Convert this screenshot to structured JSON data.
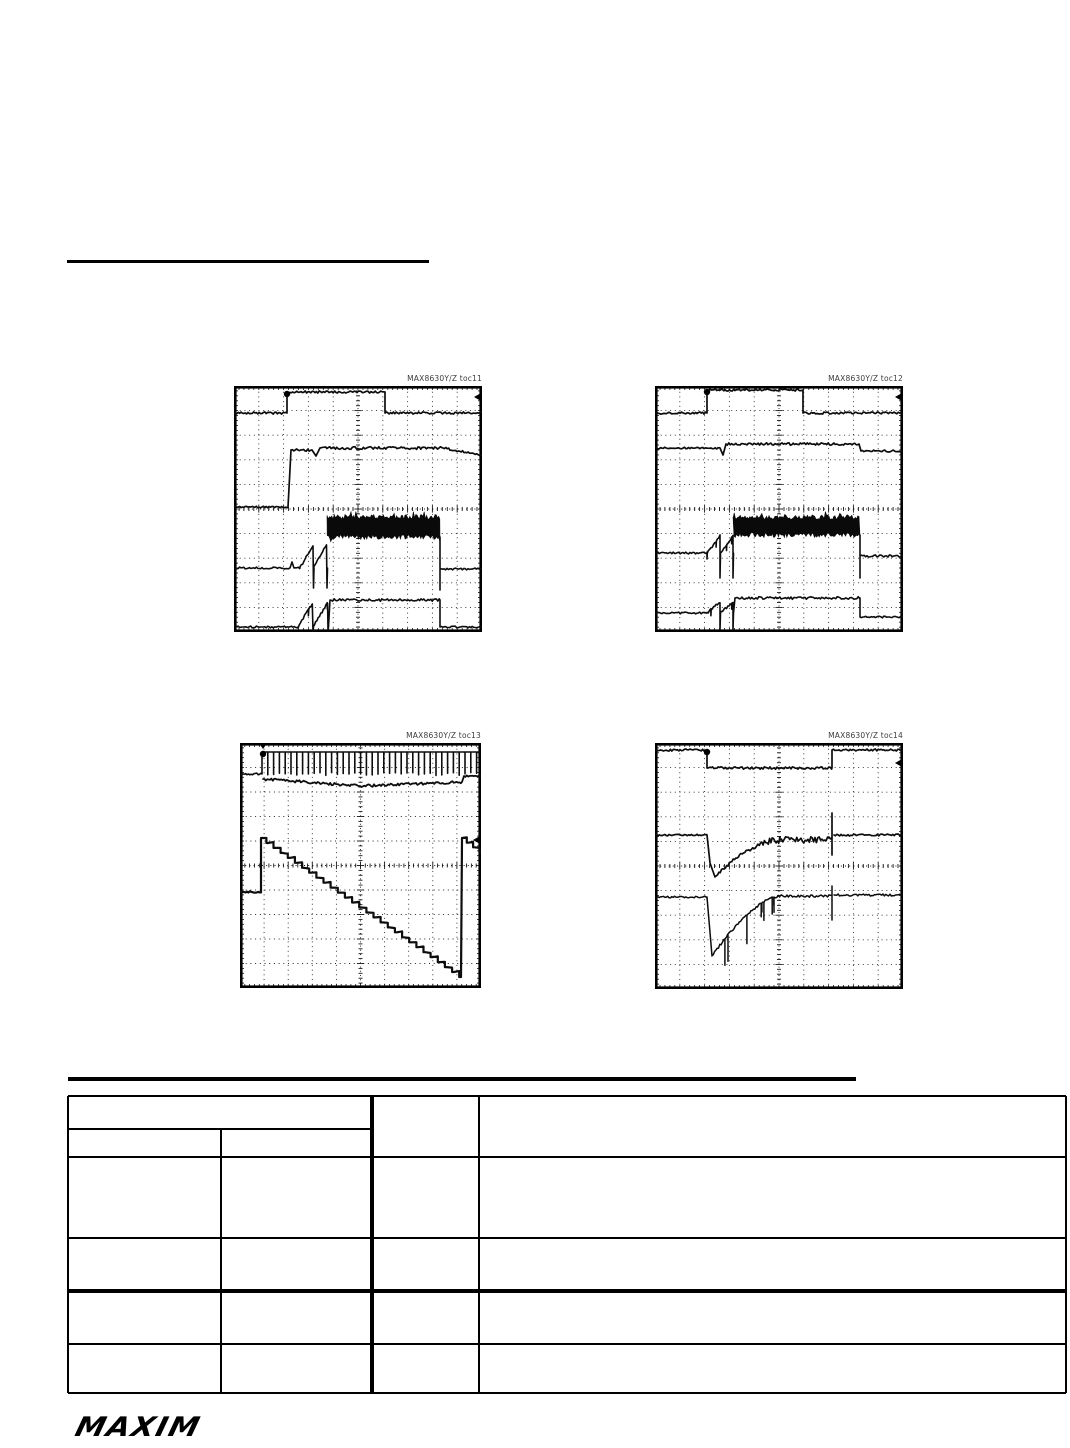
{
  "branding": {
    "logo_text": "MAXIM"
  },
  "scopes": [
    {
      "id": "toc11",
      "label": "MAX8630Y/Z toc11",
      "x": 234,
      "y": 386,
      "w": 248,
      "h": 246,
      "markers": [
        [
          "circle",
          53,
          8
        ],
        [
          "arrowL",
          248,
          11
        ]
      ],
      "traces": [
        {
          "w": 1.7,
          "ops": [
            [
              "M",
              0,
              27
            ],
            [
              "N",
              53,
              1.1
            ],
            [
              "L",
              53,
              6
            ],
            [
              "N",
              151,
              1.1
            ],
            [
              "L",
              151,
              27
            ],
            [
              "N",
              248,
              1.1
            ]
          ]
        },
        {
          "w": 1.7,
          "ops": [
            [
              "M",
              0,
              121
            ],
            [
              "N",
              54,
              0.9
            ],
            [
              "L",
              57,
              64
            ],
            [
              "N",
              78,
              1.2
            ],
            [
              "L",
              82,
              70
            ],
            [
              "L",
              86,
              62
            ],
            [
              "N",
              209,
              1.4
            ],
            [
              "D",
              248,
              69,
              1.1
            ]
          ]
        },
        {
          "w": 1.6,
          "ops": [
            [
              "M",
              0,
              182
            ],
            [
              "N",
              56,
              1.0
            ],
            [
              "L",
              58,
              176
            ],
            [
              "L",
              60,
              182
            ],
            [
              "N",
              66,
              0.9
            ],
            [
              "SAW",
              93,
              158,
              2,
              202
            ],
            [
              "M",
              93,
              141
            ],
            [
              "B",
              206,
              10,
              2.5
            ],
            [
              "SP",
              206,
              151,
              204
            ],
            [
              "M",
              206,
              183
            ],
            [
              "N",
              248,
              1.1
            ]
          ]
        },
        {
          "w": 1.6,
          "ops": [
            [
              "M",
              0,
              241
            ],
            [
              "N",
              64,
              0.9
            ],
            [
              "SAW",
              94,
              216,
              2,
              245
            ],
            [
              "L",
              96,
              214
            ],
            [
              "N",
              206,
              1.3
            ],
            [
              "L",
              206,
              241
            ],
            [
              "N",
              248,
              0.9
            ]
          ]
        }
      ]
    },
    {
      "id": "toc12",
      "label": "MAX8630Y/Z toc12",
      "x": 655,
      "y": 386,
      "w": 248,
      "h": 246,
      "markers": [
        [
          "circle",
          52,
          6
        ],
        [
          "arrowL",
          248,
          11
        ]
      ],
      "traces": [
        {
          "w": 1.7,
          "ops": [
            [
              "M",
              0,
              27
            ],
            [
              "N",
              52,
              1.1
            ],
            [
              "L",
              52,
              4
            ],
            [
              "N",
              148,
              1.1
            ],
            [
              "L",
              148,
              27
            ],
            [
              "N",
              248,
              1.1
            ]
          ]
        },
        {
          "w": 1.7,
          "ops": [
            [
              "M",
              0,
              62
            ],
            [
              "N",
              65,
              0.9
            ],
            [
              "L",
              68,
              69
            ],
            [
              "L",
              71,
              58
            ],
            [
              "N",
              204,
              1.2
            ],
            [
              "L",
              206,
              65
            ],
            [
              "N",
              248,
              1.0
            ]
          ]
        },
        {
          "w": 1.6,
          "ops": [
            [
              "M",
              0,
              167
            ],
            [
              "N",
              52,
              0.9
            ],
            [
              "SAW",
              78,
              150,
              2,
              192
            ],
            [
              "M",
              78,
              140
            ],
            [
              "B",
              205,
              9,
              2.5
            ],
            [
              "SP",
              205,
              149,
              192
            ],
            [
              "M",
              205,
              170
            ],
            [
              "N",
              248,
              1.1
            ]
          ]
        },
        {
          "w": 1.6,
          "ops": [
            [
              "M",
              0,
              227
            ],
            [
              "N",
              52,
              0.9
            ],
            [
              "SAW",
              78,
              216,
              2,
              244
            ],
            [
              "L",
              80,
              212
            ],
            [
              "N",
              205,
              1.3
            ],
            [
              "L",
              205,
              231
            ],
            [
              "N",
              248,
              0.9
            ]
          ]
        }
      ]
    },
    {
      "id": "toc13",
      "label": "MAX8630Y/Z toc13",
      "x": 240,
      "y": 743,
      "w": 241,
      "h": 245,
      "markers": [
        [
          "circle",
          23,
          11
        ],
        [
          "tee",
          23,
          0
        ],
        [
          "arrowL",
          241,
          97
        ]
      ],
      "traces": [
        {
          "w": 1.6,
          "ops": [
            [
              "M",
              0,
              31
            ],
            [
              "N",
              22,
              0.9
            ],
            [
              "L",
              22,
              9
            ],
            [
              "C",
              241,
              31,
              5.8
            ]
          ]
        },
        {
          "w": 1.8,
          "ops": [
            [
              "M",
              23,
              36
            ],
            [
              "D",
              120,
              43,
              1.3
            ],
            [
              "D",
              222,
              39,
              1.3
            ],
            [
              "L",
              224,
              33
            ],
            [
              "N",
              241,
              1.5
            ]
          ]
        },
        {
          "w": 2.2,
          "ops": [
            [
              "M",
              0,
              149
            ],
            [
              "N",
              21,
              0.8
            ],
            [
              "L",
              21,
              95
            ],
            [
              "ST",
              221,
              234,
              5
            ],
            [
              "L",
              222,
              95
            ],
            [
              "ST",
              241,
              109,
              5
            ]
          ]
        }
      ]
    },
    {
      "id": "toc14",
      "label": "MAX8630Y/Z toc14",
      "x": 655,
      "y": 743,
      "w": 248,
      "h": 246,
      "markers": [
        [
          "circle",
          52,
          9
        ],
        [
          "arrowL",
          248,
          20
        ]
      ],
      "traces": [
        {
          "w": 1.7,
          "ops": [
            [
              "M",
              0,
              7
            ],
            [
              "N",
              52,
              1.1
            ],
            [
              "L",
              52,
              25
            ],
            [
              "N",
              177,
              1.2
            ],
            [
              "L",
              177,
              7
            ],
            [
              "N",
              248,
              1.1
            ]
          ]
        },
        {
          "w": 1.7,
          "ops": [
            [
              "M",
              0,
              92
            ],
            [
              "N",
              52,
              0.9
            ],
            [
              "L",
              55,
              120
            ],
            [
              "L",
              60,
              134
            ],
            [
              "CV",
              125,
              97,
              0.8,
              3.5
            ],
            [
              "N",
              177,
              3.2
            ],
            [
              "SP",
              177,
              70,
              112
            ],
            [
              "M",
              179,
              92
            ],
            [
              "N",
              248,
              1.0
            ]
          ]
        },
        {
          "w": 1.5,
          "ops": [
            [
              "M",
              0,
              154
            ],
            [
              "N",
              52,
              0.9
            ],
            [
              "L",
              57,
              213
            ],
            [
              "CVS",
              125,
              153,
              9,
              40
            ],
            [
              "N",
              177,
              1.3
            ],
            [
              "SP",
              177,
              143,
              177
            ],
            [
              "M",
              179,
              152
            ],
            [
              "N",
              248,
              1.1
            ]
          ]
        }
      ]
    }
  ],
  "table": {
    "header": {
      "group": "",
      "sub1": "",
      "sub2": "",
      "col3": "",
      "col4": ""
    },
    "rows": [
      [
        "",
        "",
        "",
        ""
      ],
      [
        "",
        "",
        "",
        ""
      ],
      [
        "",
        "",
        "",
        ""
      ],
      [
        "",
        "",
        "",
        ""
      ]
    ]
  }
}
